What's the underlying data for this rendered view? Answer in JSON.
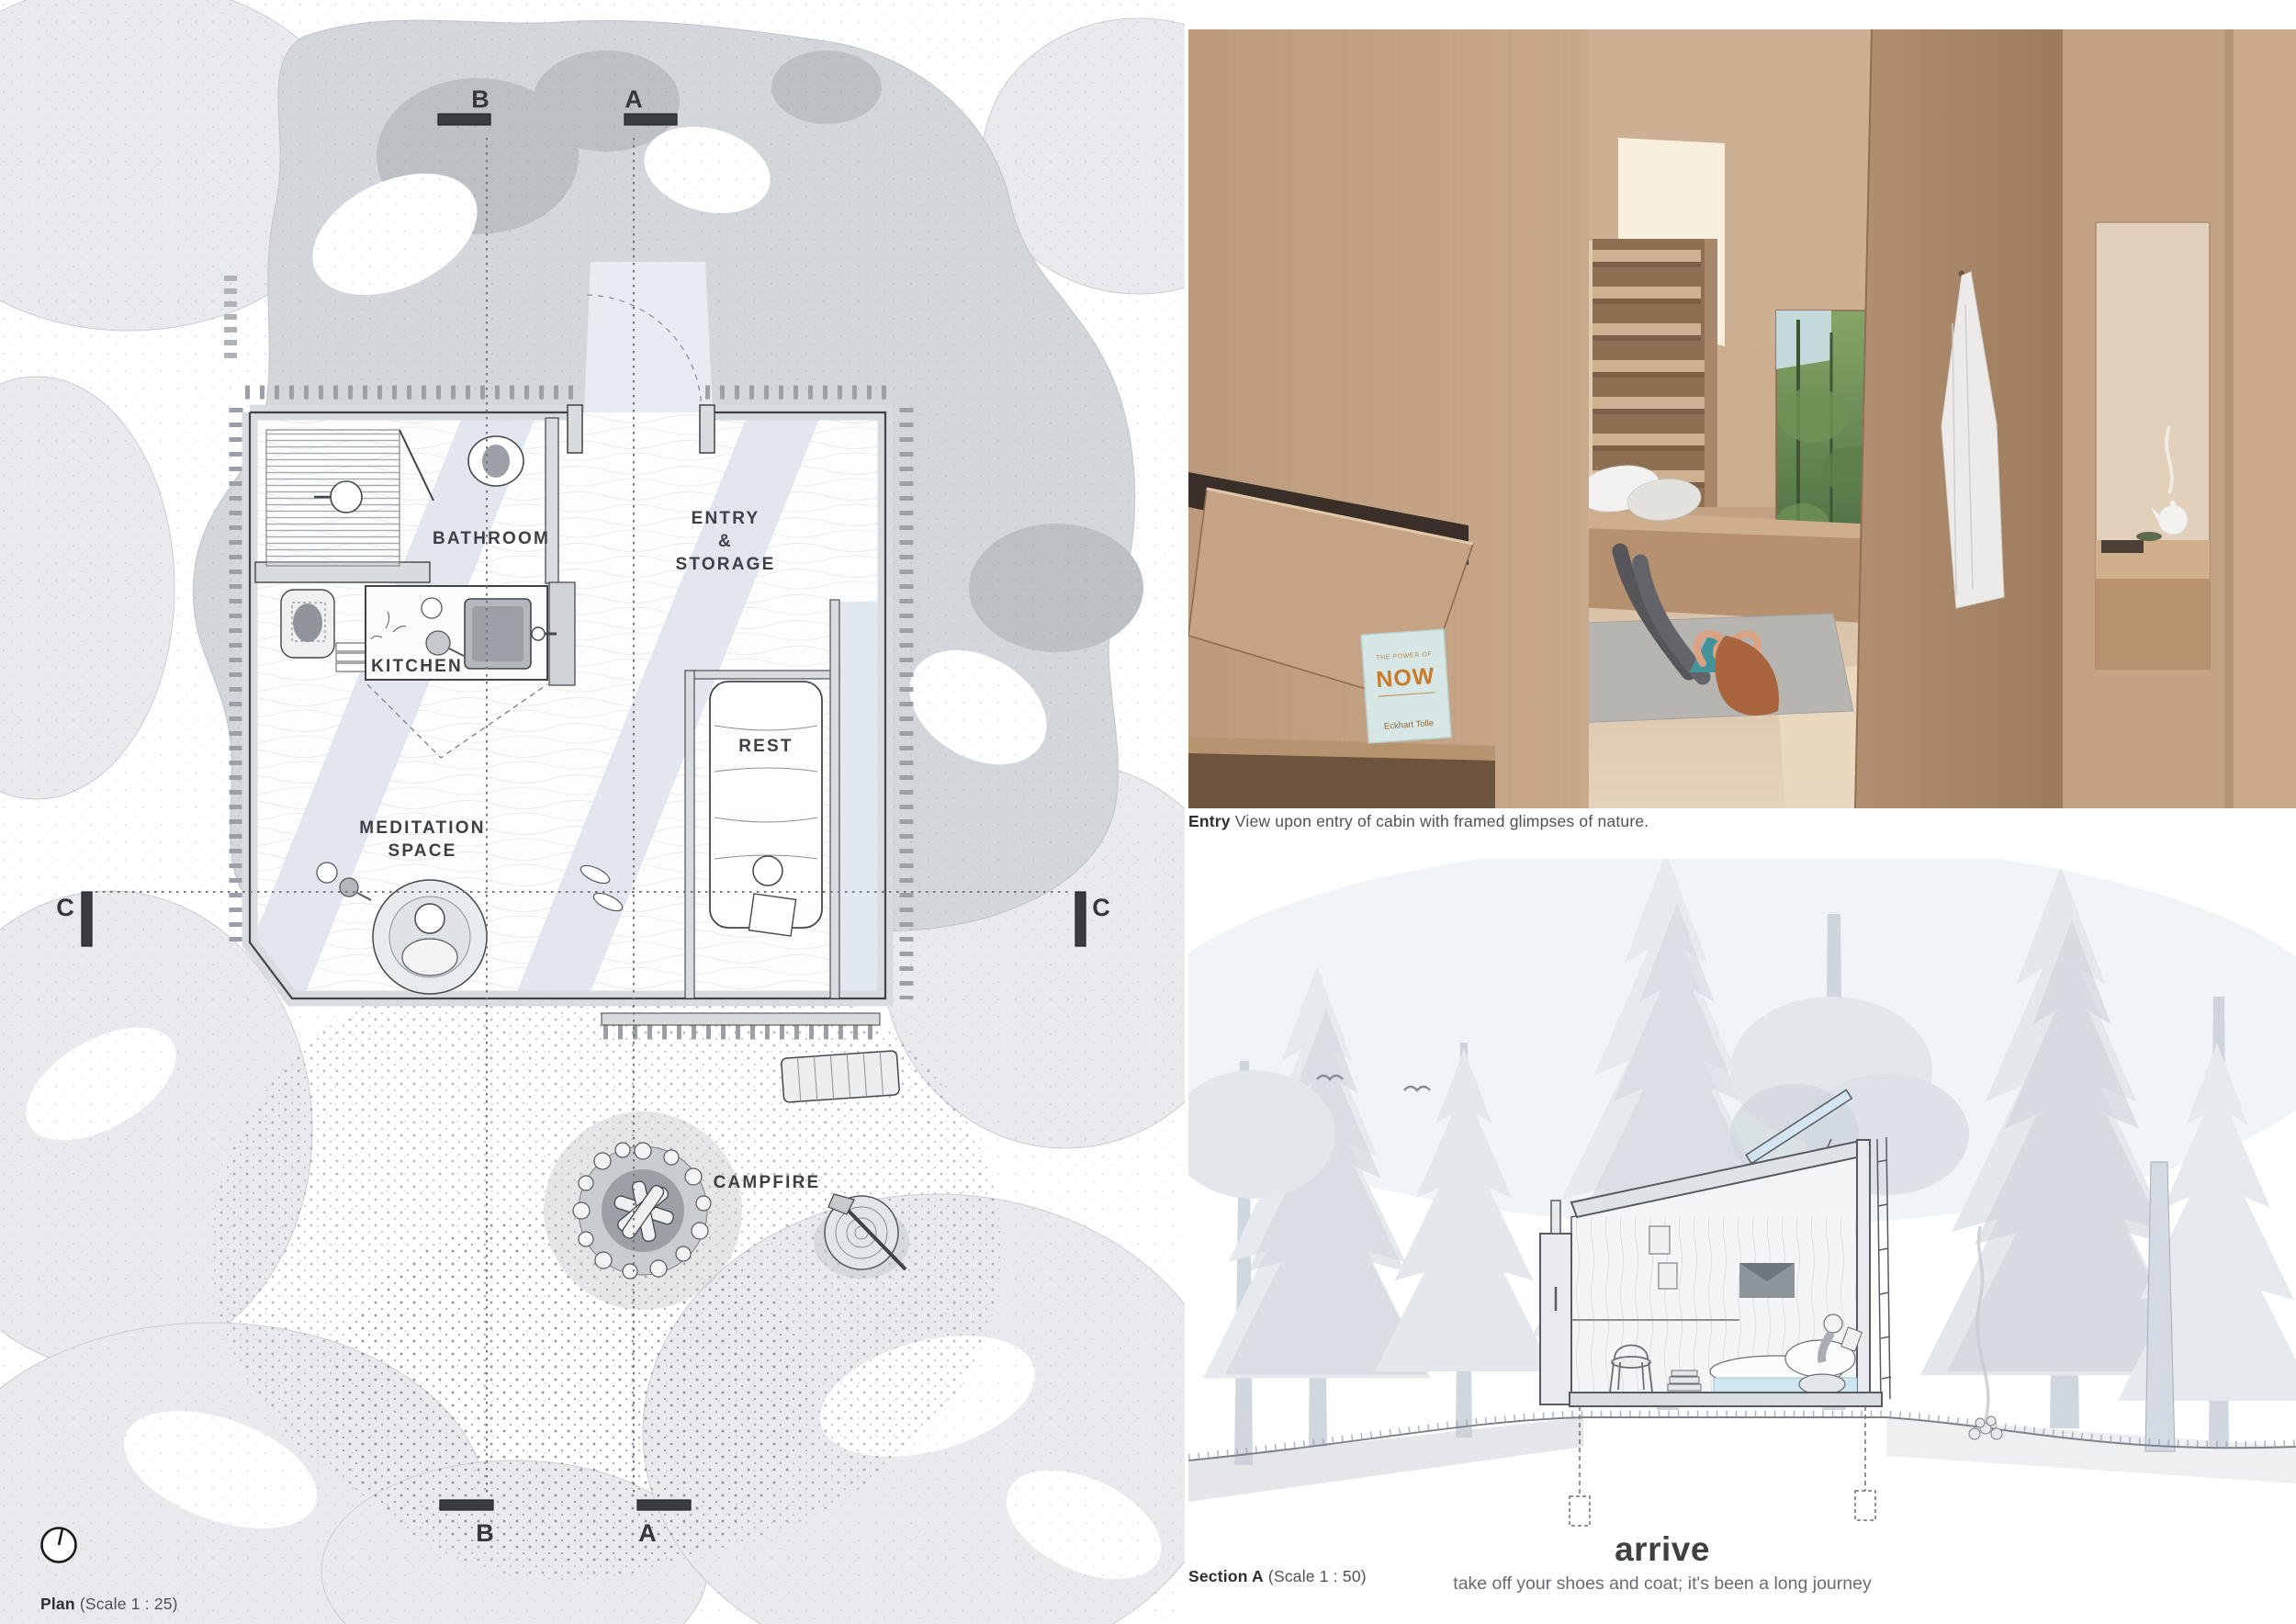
{
  "palette": {
    "ink": "#3c3f43",
    "wall_gray": "#d9dcdf",
    "site_gray": "#d3d6da",
    "canopy_gray": "#e8eaed",
    "beam_blue": "#dde2eb",
    "glazing_blue": "#dfe5ee",
    "wood_light": "#c9aa8d",
    "wood_dark": "#a8876d",
    "forest_green": "#5f814f",
    "book_teal": "#d7e7e6",
    "book_orange": "#c87c2b"
  },
  "plan": {
    "caption_bold": "Plan",
    "caption_rest": " (Scale 1 : 25)",
    "labels": {
      "bathroom": "BATHROOM",
      "kitchen": "KITCHEN",
      "entry1": "ENTRY",
      "entry2": "&",
      "entry3": "STORAGE",
      "rest": "REST",
      "meditation1": "MEDITATION",
      "meditation2": "SPACE",
      "campfire": "CAMPFIRE"
    },
    "markers": {
      "a": "A",
      "b": "B",
      "c": "C"
    }
  },
  "entry_view": {
    "caption_bold": "Entry",
    "caption_rest": " View upon entry of cabin with framed glimpses of nature.",
    "book": {
      "top": "THE POWER OF",
      "title": "NOW",
      "author": "Eckhart Tolle"
    }
  },
  "section_view": {
    "caption_bold": "Section A",
    "caption_rest": " (Scale 1 : 50)",
    "headline": "arrive",
    "subline": "take off your shoes and coat; it's been a long journey"
  }
}
